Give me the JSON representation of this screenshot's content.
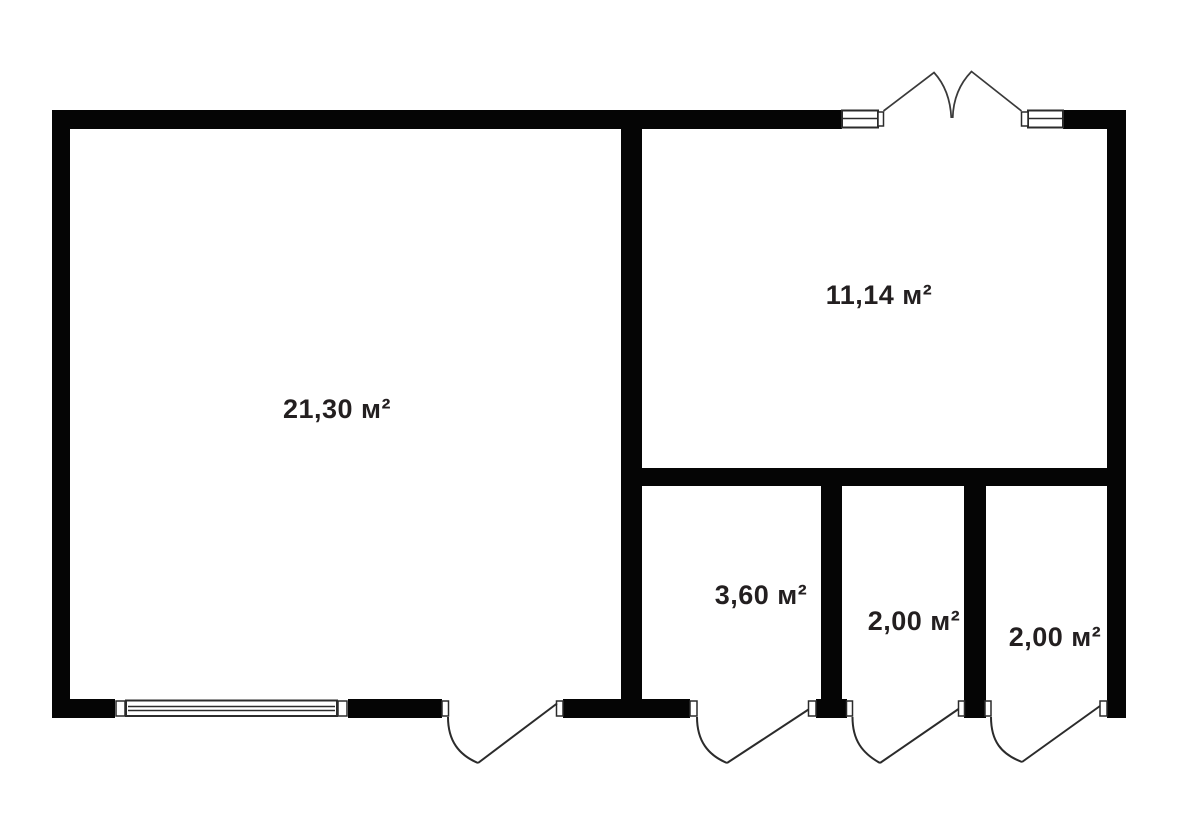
{
  "floor_plan": {
    "background_color": "#ffffff",
    "wall_color": "#050505",
    "line_color": "#2b2b2b",
    "label_color": "#231f20",
    "rooms": [
      {
        "name": "large-room",
        "area_label": "21,30 м²"
      },
      {
        "name": "upper-right-room",
        "area_label": "11,14 м²"
      },
      {
        "name": "lower-room-1",
        "area_label": "3,60 м²"
      },
      {
        "name": "lower-room-2",
        "area_label": "2,00 м²"
      },
      {
        "name": "lower-room-3",
        "area_label": "2,00 м²"
      }
    ]
  }
}
